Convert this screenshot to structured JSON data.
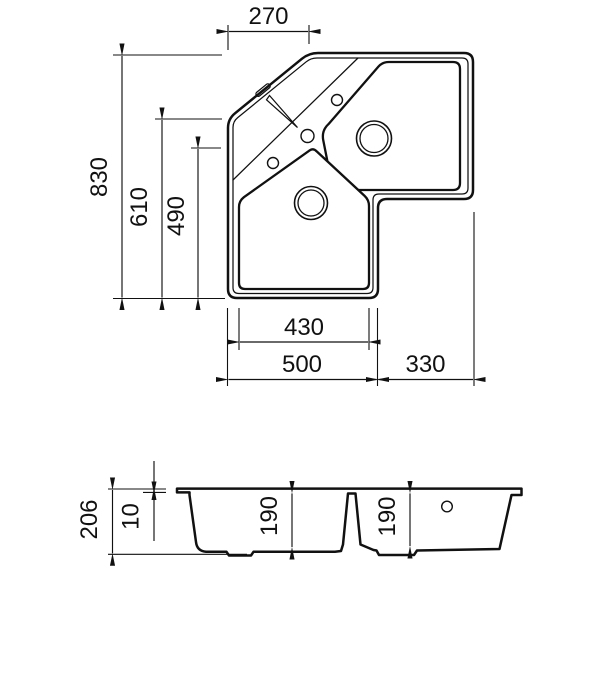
{
  "dimensions": {
    "top_view": {
      "top_width": "270",
      "overall_depth": "830",
      "left_depth": "610",
      "bowl_depth": "490",
      "bowl_width": "430",
      "left_width": "500",
      "right_width": "330"
    },
    "section_view": {
      "overall_height": "206",
      "rim_thickness": "10",
      "left_bowl_depth": "190",
      "right_bowl_depth": "190"
    }
  }
}
